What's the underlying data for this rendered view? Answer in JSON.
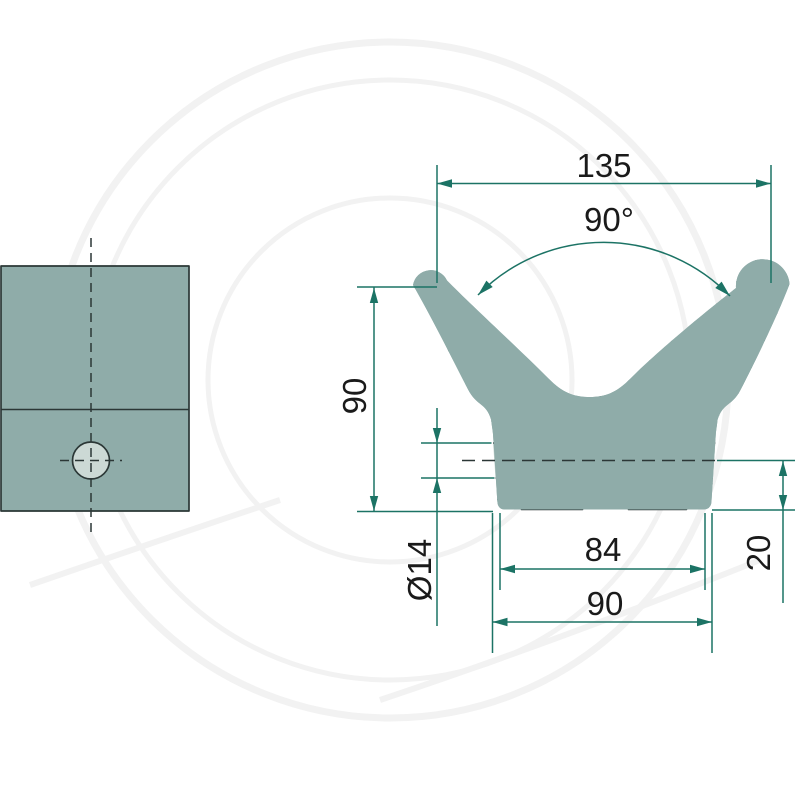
{
  "drawing": {
    "dimensions": {
      "overall_width": "135",
      "tip_angle": "90°",
      "overall_height": "90",
      "hole_diameter": "Ø14",
      "hole_center_to_base": "20",
      "inner_base_width": "84",
      "outer_base_width": "90"
    },
    "colors": {
      "body_fill": "#8FACA9",
      "hole_fill": "#CCD9D5",
      "outline": "#2B3736",
      "hatch": "#3E4F4D",
      "dimension": "#1C7365",
      "text": "#1A1A1A",
      "watermark": "#F2F2F2",
      "background": "#FFFFFF"
    }
  }
}
